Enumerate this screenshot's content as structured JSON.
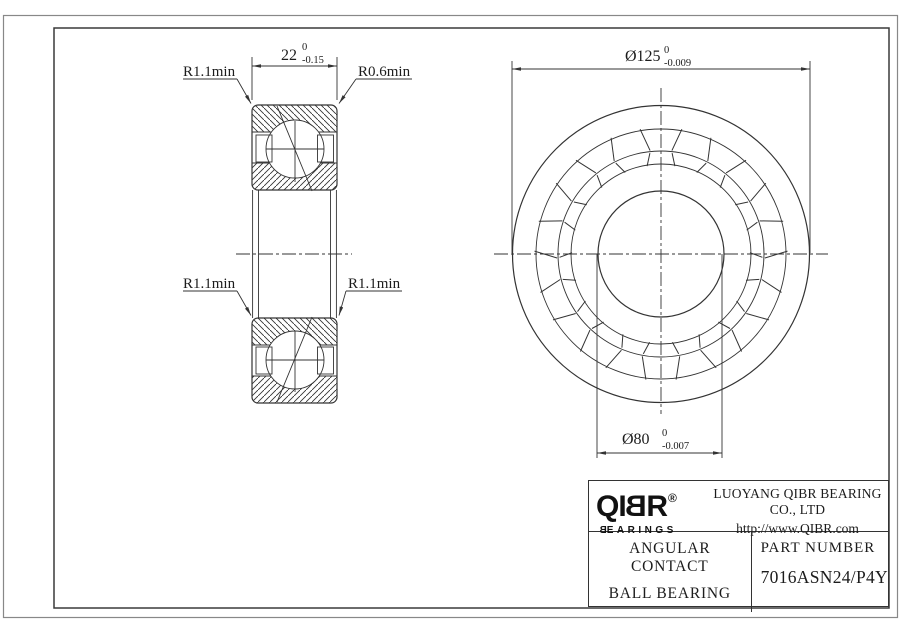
{
  "drawing": {
    "section": {
      "width_dim": {
        "value": "22",
        "tol_upper": "0",
        "tol_lower": "-0.15"
      },
      "fillet_top_left": "R1.1min",
      "fillet_top_right": "R0.6min",
      "fillet_mid_left": "R1.1min",
      "fillet_mid_right": "R1.1min"
    },
    "front_view": {
      "outer_dia_dim": {
        "value": "Ø125",
        "tol_upper": "0",
        "tol_lower": "-0.009"
      },
      "bore_dia_dim": {
        "value": "Ø80",
        "tol_upper": "0",
        "tol_lower": "-0.007"
      }
    }
  },
  "title_block": {
    "brand_letters": {
      "l1": "Q",
      "l2": "I",
      "l3": "B",
      "l4": "R"
    },
    "brand_registered": "®",
    "tagline_letters": {
      "first": "B",
      "rest": "EARINGS"
    },
    "company": "LUOYANG QIBR BEARING CO., LTD",
    "website": "http://www.QIBR.com",
    "product_type_line1": "ANGULAR CONTACT",
    "product_type_line2": "BALL BEARING",
    "part_number_label": "PART NUMBER",
    "part_number_value": "7016ASN24/P4Y"
  },
  "colors": {
    "line": "#333333",
    "background": "#ffffff"
  }
}
